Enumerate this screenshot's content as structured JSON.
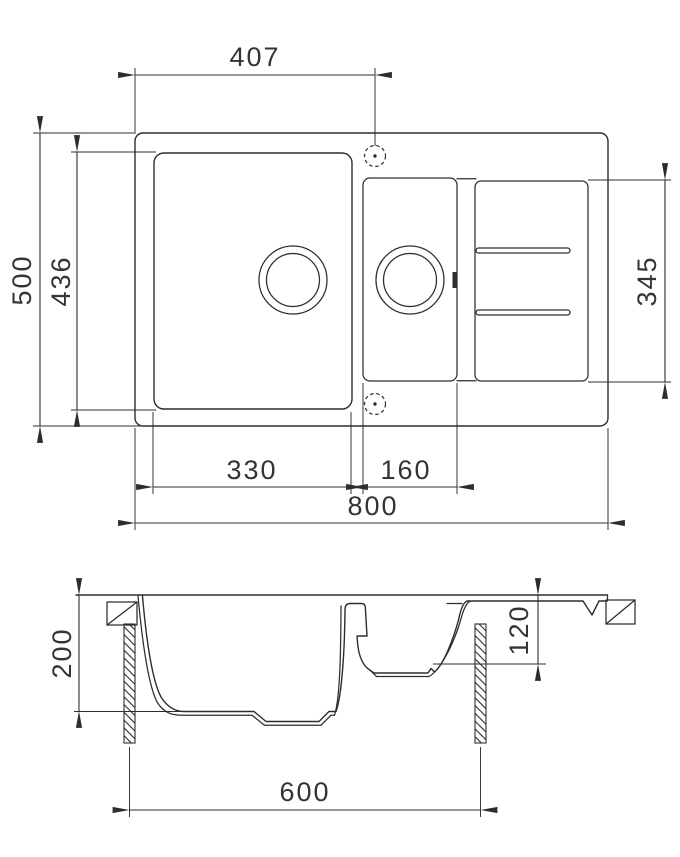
{
  "drawing": {
    "type": "kitchen-sink-technical-drawing",
    "views": [
      "top-view",
      "section-view"
    ],
    "colors": {
      "line": "#2d2d2d",
      "text": "#343434",
      "background": "#ffffff"
    }
  },
  "dimensions": {
    "tap_hole_offset": "407",
    "overall_depth": "500",
    "main_bowl_length": "436",
    "right_zone_length": "345",
    "main_bowl_width": "330",
    "small_bowl_width": "160",
    "overall_width": "800",
    "main_bowl_depth": "200",
    "small_bowl_depth": "120",
    "cabinet_width": "600"
  }
}
